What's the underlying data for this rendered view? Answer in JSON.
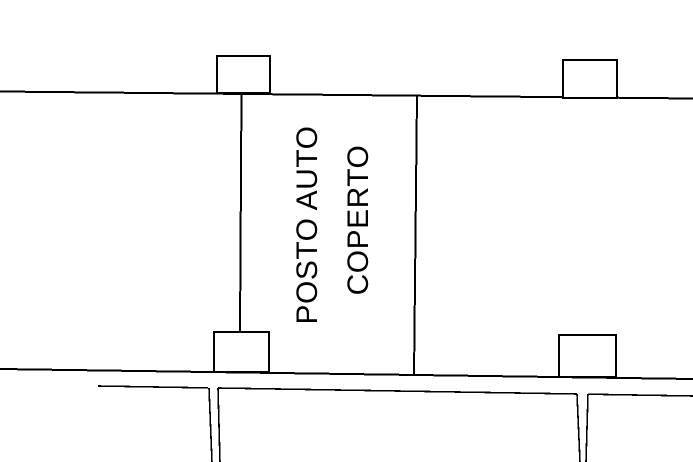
{
  "plan": {
    "space_label": {
      "line1": "POSTO AUTO",
      "line2": "COPERTO"
    }
  },
  "colors": {
    "background": "#ffffff",
    "line": "#000000",
    "text": "#000000"
  }
}
